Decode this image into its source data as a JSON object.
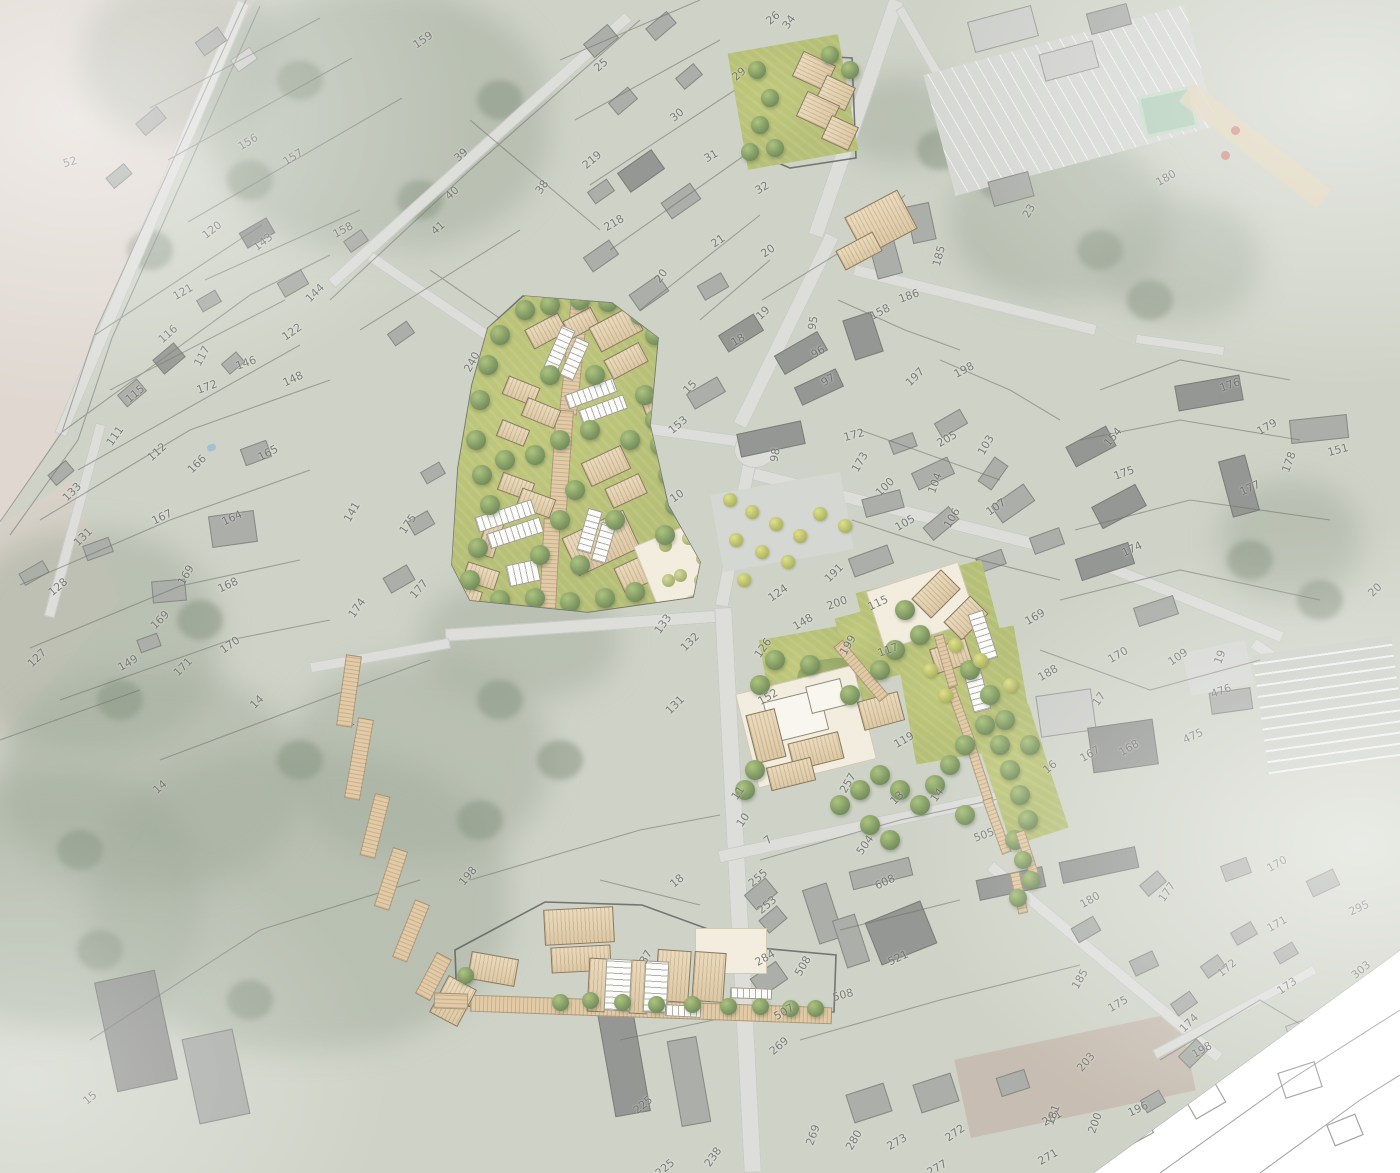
{
  "map": {
    "type": "aerial-masterplan-site-plan",
    "icons": {
      "path_arrows": "◁▷"
    },
    "colors": {
      "masterplan_green": "#a6b259",
      "roof_tan": "#e2cba0",
      "path_tan": "#dcc094",
      "plaza_cream": "#f0e9d7",
      "aerial_road": "#d6d7d3",
      "aerial_building": "#9a9d98",
      "field_pink": "#d9cfc7",
      "white_sector": "#ffffff"
    },
    "parcel_labels": [
      {
        "n": "52",
        "x": 70,
        "y": 162,
        "r": -15
      },
      {
        "n": "159",
        "x": 423,
        "y": 40,
        "r": -35
      },
      {
        "n": "156",
        "x": 248,
        "y": 142,
        "r": -32
      },
      {
        "n": "157",
        "x": 293,
        "y": 157,
        "r": -32
      },
      {
        "n": "39",
        "x": 461,
        "y": 155,
        "r": -42
      },
      {
        "n": "40",
        "x": 452,
        "y": 193,
        "r": -42
      },
      {
        "n": "41",
        "x": 438,
        "y": 228,
        "r": -42
      },
      {
        "n": "38",
        "x": 542,
        "y": 187,
        "r": -55
      },
      {
        "n": "158",
        "x": 343,
        "y": 230,
        "r": -28
      },
      {
        "n": "120",
        "x": 212,
        "y": 230,
        "r": -38
      },
      {
        "n": "143",
        "x": 263,
        "y": 242,
        "r": -38
      },
      {
        "n": "121",
        "x": 183,
        "y": 292,
        "r": -30
      },
      {
        "n": "116",
        "x": 168,
        "y": 334,
        "r": -42
      },
      {
        "n": "117",
        "x": 202,
        "y": 356,
        "r": -62
      },
      {
        "n": "146",
        "x": 246,
        "y": 363,
        "r": -20
      },
      {
        "n": "148",
        "x": 293,
        "y": 379,
        "r": -25
      },
      {
        "n": "122",
        "x": 292,
        "y": 332,
        "r": -35
      },
      {
        "n": "144",
        "x": 315,
        "y": 293,
        "r": -45
      },
      {
        "n": "172",
        "x": 207,
        "y": 387,
        "r": -20
      },
      {
        "n": "115",
        "x": 135,
        "y": 394,
        "r": -40
      },
      {
        "n": "111",
        "x": 115,
        "y": 436,
        "r": -55
      },
      {
        "n": "112",
        "x": 157,
        "y": 452,
        "r": -42
      },
      {
        "n": "133",
        "x": 72,
        "y": 492,
        "r": -45
      },
      {
        "n": "166",
        "x": 197,
        "y": 464,
        "r": -45
      },
      {
        "n": "165",
        "x": 268,
        "y": 453,
        "r": -28
      },
      {
        "n": "167",
        "x": 162,
        "y": 517,
        "r": -25
      },
      {
        "n": "131",
        "x": 83,
        "y": 537,
        "r": -45
      },
      {
        "n": "128",
        "x": 58,
        "y": 587,
        "r": -40
      },
      {
        "n": "164",
        "x": 232,
        "y": 518,
        "r": -25
      },
      {
        "n": "169",
        "x": 186,
        "y": 575,
        "r": -60
      },
      {
        "n": "168",
        "x": 228,
        "y": 585,
        "r": -25
      },
      {
        "n": "169",
        "x": 160,
        "y": 620,
        "r": -45
      },
      {
        "n": "170",
        "x": 230,
        "y": 645,
        "r": -35
      },
      {
        "n": "171",
        "x": 183,
        "y": 667,
        "r": -45
      },
      {
        "n": "127",
        "x": 37,
        "y": 658,
        "r": -45
      },
      {
        "n": "149",
        "x": 128,
        "y": 663,
        "r": -30
      },
      {
        "n": "14",
        "x": 257,
        "y": 702,
        "r": -45
      },
      {
        "n": "174",
        "x": 357,
        "y": 608,
        "r": -55
      },
      {
        "n": "240",
        "x": 472,
        "y": 362,
        "r": -62
      },
      {
        "n": "141",
        "x": 352,
        "y": 512,
        "r": -60
      },
      {
        "n": "175",
        "x": 408,
        "y": 524,
        "r": -55
      },
      {
        "n": "177",
        "x": 419,
        "y": 589,
        "r": -50
      },
      {
        "n": "15",
        "x": 690,
        "y": 387,
        "r": -45
      },
      {
        "n": "153",
        "x": 678,
        "y": 425,
        "r": -40
      },
      {
        "n": "10",
        "x": 677,
        "y": 496,
        "r": -35
      },
      {
        "n": "14",
        "x": 160,
        "y": 787,
        "r": -42
      },
      {
        "n": "15",
        "x": 90,
        "y": 1098,
        "r": -40
      },
      {
        "n": "198",
        "x": 468,
        "y": 876,
        "r": -50
      },
      {
        "n": "26",
        "x": 773,
        "y": 18,
        "r": -40
      },
      {
        "n": "34",
        "x": 789,
        "y": 22,
        "r": -55
      },
      {
        "n": "25",
        "x": 601,
        "y": 65,
        "r": -40
      },
      {
        "n": "29",
        "x": 739,
        "y": 74,
        "r": -40
      },
      {
        "n": "30",
        "x": 677,
        "y": 115,
        "r": -40
      },
      {
        "n": "31",
        "x": 711,
        "y": 156,
        "r": -30
      },
      {
        "n": "219",
        "x": 592,
        "y": 160,
        "r": -40
      },
      {
        "n": "32",
        "x": 762,
        "y": 188,
        "r": -30
      },
      {
        "n": "218",
        "x": 614,
        "y": 223,
        "r": -30
      },
      {
        "n": "21",
        "x": 718,
        "y": 241,
        "r": -35
      },
      {
        "n": "20",
        "x": 768,
        "y": 251,
        "r": -35
      },
      {
        "n": "20",
        "x": 661,
        "y": 276,
        "r": -55
      },
      {
        "n": "185",
        "x": 939,
        "y": 256,
        "r": -75
      },
      {
        "n": "186",
        "x": 909,
        "y": 296,
        "r": -20
      },
      {
        "n": "19",
        "x": 763,
        "y": 313,
        "r": -45
      },
      {
        "n": "18",
        "x": 738,
        "y": 340,
        "r": -30
      },
      {
        "n": "95",
        "x": 813,
        "y": 323,
        "r": -80
      },
      {
        "n": "96",
        "x": 818,
        "y": 352,
        "r": -30
      },
      {
        "n": "97",
        "x": 828,
        "y": 380,
        "r": -30
      },
      {
        "n": "158",
        "x": 880,
        "y": 312,
        "r": -28
      },
      {
        "n": "197",
        "x": 915,
        "y": 377,
        "r": -45
      },
      {
        "n": "198",
        "x": 964,
        "y": 370,
        "r": -28
      },
      {
        "n": "98",
        "x": 775,
        "y": 455,
        "r": -80
      },
      {
        "n": "172",
        "x": 854,
        "y": 435,
        "r": -15
      },
      {
        "n": "173",
        "x": 860,
        "y": 462,
        "r": -60
      },
      {
        "n": "205",
        "x": 947,
        "y": 439,
        "r": -30
      },
      {
        "n": "103",
        "x": 986,
        "y": 445,
        "r": -60
      },
      {
        "n": "100",
        "x": 885,
        "y": 487,
        "r": -45
      },
      {
        "n": "104",
        "x": 935,
        "y": 483,
        "r": -70
      },
      {
        "n": "105",
        "x": 905,
        "y": 523,
        "r": -30
      },
      {
        "n": "106",
        "x": 952,
        "y": 518,
        "r": -60
      },
      {
        "n": "107",
        "x": 996,
        "y": 507,
        "r": -35
      },
      {
        "n": "180",
        "x": 1166,
        "y": 178,
        "r": -30
      },
      {
        "n": "23",
        "x": 1029,
        "y": 211,
        "r": -60
      },
      {
        "n": "176",
        "x": 1230,
        "y": 385,
        "r": -20
      },
      {
        "n": "179",
        "x": 1267,
        "y": 427,
        "r": -30
      },
      {
        "n": "151",
        "x": 1338,
        "y": 450,
        "r": -15
      },
      {
        "n": "154",
        "x": 1113,
        "y": 437,
        "r": -50
      },
      {
        "n": "175",
        "x": 1124,
        "y": 473,
        "r": -20
      },
      {
        "n": "177",
        "x": 1250,
        "y": 488,
        "r": -25
      },
      {
        "n": "178",
        "x": 1289,
        "y": 462,
        "r": -70
      },
      {
        "n": "174",
        "x": 1132,
        "y": 549,
        "r": -25
      },
      {
        "n": "20",
        "x": 1375,
        "y": 590,
        "r": -45
      },
      {
        "n": "169",
        "x": 1035,
        "y": 617,
        "r": -30
      },
      {
        "n": "124",
        "x": 778,
        "y": 593,
        "r": -35
      },
      {
        "n": "133",
        "x": 663,
        "y": 624,
        "r": -55
      },
      {
        "n": "132",
        "x": 690,
        "y": 642,
        "r": -45
      },
      {
        "n": "126",
        "x": 763,
        "y": 648,
        "r": -55
      },
      {
        "n": "152",
        "x": 768,
        "y": 697,
        "r": -30
      },
      {
        "n": "131",
        "x": 675,
        "y": 705,
        "r": -45
      },
      {
        "n": "191",
        "x": 834,
        "y": 573,
        "r": -45
      },
      {
        "n": "200",
        "x": 837,
        "y": 603,
        "r": -20
      },
      {
        "n": "115",
        "x": 878,
        "y": 603,
        "r": -25
      },
      {
        "n": "148",
        "x": 803,
        "y": 622,
        "r": -30
      },
      {
        "n": "199",
        "x": 848,
        "y": 645,
        "r": -60
      },
      {
        "n": "117",
        "x": 888,
        "y": 650,
        "r": -20
      },
      {
        "n": "119",
        "x": 904,
        "y": 740,
        "r": -30
      },
      {
        "n": "257",
        "x": 848,
        "y": 783,
        "r": -60
      },
      {
        "n": "14",
        "x": 937,
        "y": 795,
        "r": -55
      },
      {
        "n": "13",
        "x": 897,
        "y": 798,
        "r": -45
      },
      {
        "n": "16",
        "x": 1050,
        "y": 767,
        "r": -40
      },
      {
        "n": "505",
        "x": 984,
        "y": 835,
        "r": -20
      },
      {
        "n": "504",
        "x": 865,
        "y": 845,
        "r": -55
      },
      {
        "n": "11",
        "x": 738,
        "y": 793,
        "r": -55
      },
      {
        "n": "10",
        "x": 743,
        "y": 820,
        "r": -55
      },
      {
        "n": "7",
        "x": 768,
        "y": 840,
        "r": -40
      },
      {
        "n": "188",
        "x": 1048,
        "y": 673,
        "r": -30
      },
      {
        "n": "170",
        "x": 1118,
        "y": 655,
        "r": -30
      },
      {
        "n": "109",
        "x": 1178,
        "y": 657,
        "r": -35
      },
      {
        "n": "19",
        "x": 1220,
        "y": 657,
        "r": -70
      },
      {
        "n": "476",
        "x": 1221,
        "y": 691,
        "r": -20
      },
      {
        "n": "475",
        "x": 1193,
        "y": 736,
        "r": -25
      },
      {
        "n": "168",
        "x": 1129,
        "y": 748,
        "r": -30
      },
      {
        "n": "167",
        "x": 1090,
        "y": 754,
        "r": -30
      },
      {
        "n": "17",
        "x": 1099,
        "y": 699,
        "r": -55
      },
      {
        "n": "18",
        "x": 677,
        "y": 881,
        "r": -40
      },
      {
        "n": "255",
        "x": 758,
        "y": 878,
        "r": -40
      },
      {
        "n": "253",
        "x": 767,
        "y": 905,
        "r": -40
      },
      {
        "n": "284",
        "x": 765,
        "y": 958,
        "r": -30
      },
      {
        "n": "508",
        "x": 803,
        "y": 966,
        "r": -60
      },
      {
        "n": "508",
        "x": 843,
        "y": 995,
        "r": -15
      },
      {
        "n": "521",
        "x": 898,
        "y": 958,
        "r": -25
      },
      {
        "n": "608",
        "x": 885,
        "y": 882,
        "r": -25
      },
      {
        "n": "507",
        "x": 784,
        "y": 1012,
        "r": -30
      },
      {
        "n": "37",
        "x": 646,
        "y": 957,
        "r": -60
      },
      {
        "n": "269",
        "x": 779,
        "y": 1046,
        "r": -40
      },
      {
        "n": "225",
        "x": 643,
        "y": 1105,
        "r": -40
      },
      {
        "n": "225",
        "x": 665,
        "y": 1168,
        "r": -40
      },
      {
        "n": "238",
        "x": 713,
        "y": 1157,
        "r": -55
      },
      {
        "n": "269",
        "x": 813,
        "y": 1135,
        "r": -70
      },
      {
        "n": "280",
        "x": 854,
        "y": 1140,
        "r": -60
      },
      {
        "n": "273",
        "x": 897,
        "y": 1142,
        "r": -30
      },
      {
        "n": "272",
        "x": 955,
        "y": 1133,
        "r": -35
      },
      {
        "n": "277",
        "x": 937,
        "y": 1168,
        "r": -30
      },
      {
        "n": "281",
        "x": 1052,
        "y": 1118,
        "r": -30
      },
      {
        "n": "271",
        "x": 1048,
        "y": 1157,
        "r": -30
      },
      {
        "n": "170",
        "x": 1277,
        "y": 864,
        "r": -30
      },
      {
        "n": "177",
        "x": 1167,
        "y": 892,
        "r": -55
      },
      {
        "n": "180",
        "x": 1090,
        "y": 900,
        "r": -30
      },
      {
        "n": "295",
        "x": 1359,
        "y": 908,
        "r": -25
      },
      {
        "n": "171",
        "x": 1277,
        "y": 924,
        "r": -30
      },
      {
        "n": "185",
        "x": 1080,
        "y": 979,
        "r": -60
      },
      {
        "n": "303",
        "x": 1361,
        "y": 970,
        "r": -40
      },
      {
        "n": "172",
        "x": 1227,
        "y": 968,
        "r": -40
      },
      {
        "n": "173",
        "x": 1287,
        "y": 986,
        "r": -35
      },
      {
        "n": "175",
        "x": 1118,
        "y": 1004,
        "r": -30
      },
      {
        "n": "174",
        "x": 1189,
        "y": 1023,
        "r": -45
      },
      {
        "n": "198",
        "x": 1202,
        "y": 1050,
        "r": -30
      },
      {
        "n": "203",
        "x": 1086,
        "y": 1062,
        "r": -50
      },
      {
        "n": "196",
        "x": 1138,
        "y": 1109,
        "r": -25
      },
      {
        "n": "200",
        "x": 1095,
        "y": 1123,
        "r": -70
      },
      {
        "n": "181",
        "x": 1053,
        "y": 1115,
        "r": -70
      }
    ]
  }
}
